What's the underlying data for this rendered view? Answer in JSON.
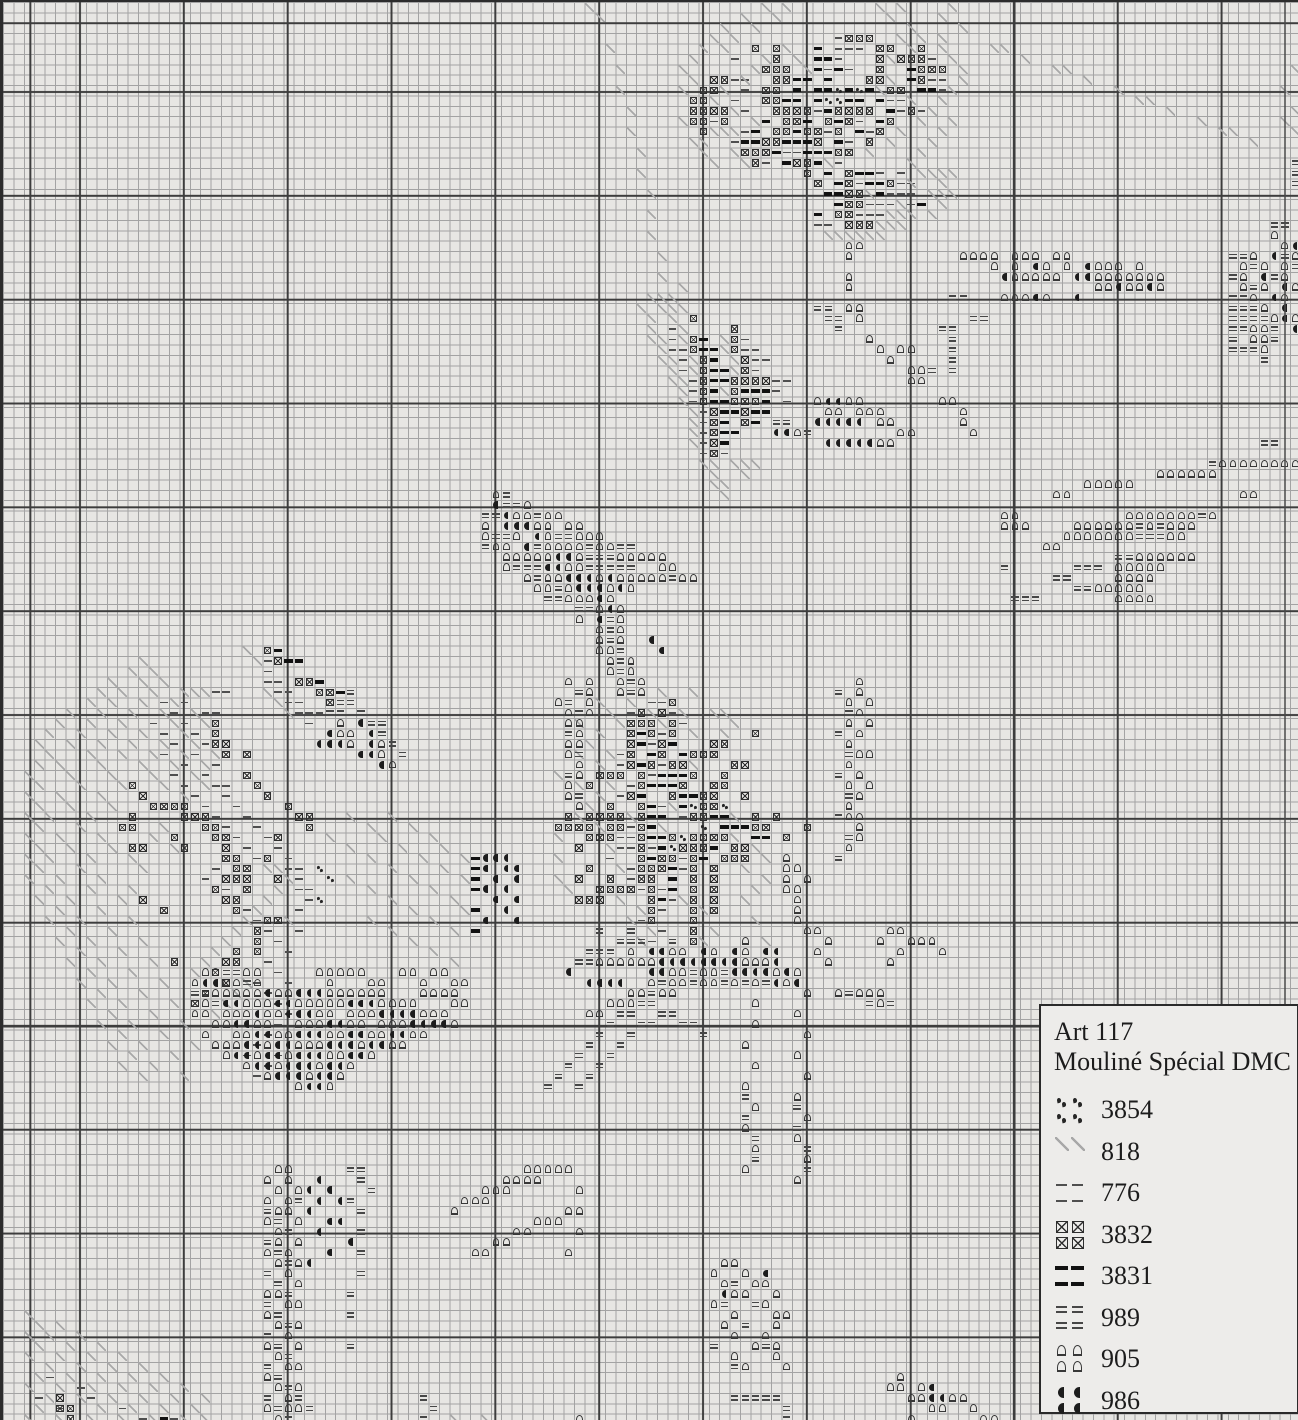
{
  "legend": {
    "title_line1": "Art 117",
    "title_line2": "Mouliné Spécial DMC",
    "entries": [
      {
        "code": "3854",
        "symbol": "3854",
        "icon": "double-dots-icon",
        "cells": 4
      },
      {
        "code": "818",
        "symbol": "818",
        "icon": "diagonal-line-icon",
        "cells": 2
      },
      {
        "code": "776",
        "symbol": "776",
        "icon": "thin-dash-icon",
        "cells": 4
      },
      {
        "code": "3832",
        "symbol": "3832",
        "icon": "boxed-x-icon",
        "cells": 4
      },
      {
        "code": "3831",
        "symbol": "3831",
        "icon": "bold-dash-icon",
        "cells": 4
      },
      {
        "code": "989",
        "symbol": "989",
        "icon": "double-dash-icon",
        "cells": 4
      },
      {
        "code": "905",
        "symbol": "905",
        "icon": "arch-icon",
        "cells": 4
      },
      {
        "code": "986",
        "symbol": "986",
        "icon": "half-moon-icon",
        "cells": 4
      }
    ]
  },
  "grid": {
    "cell": 10.38,
    "cols": 125,
    "rows": 137,
    "paper": "#e7e6e3",
    "thin_color": "#a3a3a3",
    "bold_color": "#3d3d3d",
    "bold_x_offset": 76,
    "bold_y_offset": 89
  },
  "symbol_colors": {
    "3854": "#262626",
    "818": "#a8a8a8",
    "776": "#4f4f4f",
    "3832": "#2e2e2e",
    "3831": "#121212",
    "989": "#474747",
    "905": "#383838",
    "986": "#1c1c1c"
  },
  "pattern": {
    "3854": [
      "8:80,82",
      "9:79-80",
      "77:66,69",
      "79:67",
      "80:65",
      "81:64",
      "83:30",
      "84:31",
      "86:30"
    ],
    "818": [
      "0:56,73,75,84,86,91",
      "1:57,71,74,85,90",
      "2:69,72,87,92",
      "3:68,70,86,88,90",
      "4:58,67,69,75,87,90,95-96",
      "5:66,73,76,85,91,98",
      "6:59,65,72,77,92,101-102,124",
      "7:66,71,85,92,104",
      "8:59,65,69,84,91,107,123",
      "9:68,87,90,109-110",
      "10:60,70,89,112,124",
      "11:65,72,88,91,115,123",
      "12:60,68-70,86,90,117-118,124",
      "13:66-67,85,89,120",
      "14:61,67,70,83,88",
      "15:68,71,79,87",
      "16:61,88-91",
      "17:87,90",
      "18:62,83,89-91",
      "19:86,90",
      "20:62,85-87,89",
      "21:84-86",
      "22:62,79-84",
      "24:63",
      "26:63",
      "27:65",
      "28:62-64",
      "29:61,63-65",
      "30:62,64",
      "31:62,65",
      "32:62-63,65,69",
      "33:63,69",
      "34:63-64,66,70",
      "35:64,66,70",
      "36:64-65",
      "37:65,69",
      "38:65",
      "39:66",
      "40:66",
      "41:66",
      "42:66",
      "44:67-68,70-72",
      "45:68,71",
      "46:68-69",
      "47:69",
      "62:23",
      "63:13,24",
      "64:12,14",
      "65:10,13,15",
      "66:9,11,14,17-19,25",
      "67:8,10,13,16,26",
      "68:6,9,12,15,18,27",
      "69:5,8,11,16,19",
      "70:4,7,10,13,17",
      "71:3,6,9,12,15,18",
      "72:4,8,11,14,17,20",
      "73:3,5,9,13,16,19",
      "74:2,6,10,14,18",
      "75:3,7,11,15,19",
      "76:2,5,9,17",
      "77:3,6,10",
      "78:2,4,8,33,37",
      "79:3,7,15,35,39",
      "80:2,5,9,14,31,36,41",
      "81:3,6,10,16,33,38,42",
      "82:2,4,8,12,35,40,44",
      "83:3,7,13,25-26,37,42",
      "84:2,5,9,27,33,39,44",
      "85:4,8,12,26,35,41",
      "86:3,6,11,25,37,43",
      "87:5,9,24,39,44",
      "88:4,7,12,23,27,35,41",
      "89:6,10,22,37,43",
      "90:5,8,13,21,39",
      "91:7,11,20,41",
      "92:6,9,14,19,43",
      "93:8,12,18",
      "94:7,10,15,23",
      "95:9,13,22",
      "96:8,11,16,21",
      "97:10,14,20",
      "98:9,12,17",
      "99:11,15",
      "100:10,13,18",
      "101:12,16",
      "102:11,14",
      "103:13,17",
      "66:63,66",
      "67:57,60",
      "68:58,62,65,68-69",
      "69:55,59,63,70",
      "70:57,66,69",
      "71:56",
      "72:55,58",
      "73:57,66",
      "74:53",
      "75:55,58",
      "76:57",
      "77:56,64",
      "78:55,60,70",
      "79:57,63",
      "80:53,70",
      "81:58,72",
      "82:53,73",
      "83:59,71",
      "84:53,73",
      "85:54,72",
      "86:59,65,71",
      "87:61,67",
      "88:60,72",
      "89:62,68",
      "90:61,67,73",
      "126:2",
      "127:3,5",
      "128:2,4,7",
      "129:3,6,9",
      "130:2,5,8,11",
      "131:4,7,10,13",
      "132:3,6,9,12,15",
      "133:2,5,8,11,14,17",
      "134:4,7,10,13,16,19",
      "135:3,9,12,15,18",
      "136:2,5,8,11,14,17,19,43,46"
    ],
    "776": [
      "3:80",
      "4:80-82",
      "5:70,80,89",
      "6:79,81",
      "7:70-71,89-90",
      "8:71,90",
      "9:70,85-86",
      "10:71,78,86,88",
      "11:68,82",
      "12:71,79,83",
      "13:70,81",
      "14:75-76",
      "15:73,80",
      "16:84,86",
      "17:82,86-87",
      "18:85-87",
      "19:83-85,87",
      "20:82-84",
      "21:78-79",
      "31:64",
      "32:64,71",
      "33:64-65,71-72",
      "34:65,72-73",
      "35:65,72",
      "36:66,74-75",
      "37:66,74",
      "38:66,75",
      "39:67",
      "40:67",
      "41:67",
      "42:67",
      "43:67,69",
      "63:25",
      "64:25",
      "65:25-26",
      "66:26-27",
      "67:27-28",
      "68:28-30",
      "69:29",
      "66:20-21",
      "67:15,17",
      "68:16,19-20",
      "69:14,17",
      "70:15,18",
      "71:16,19",
      "72:15,18",
      "73:17,20",
      "74:16,19",
      "75:17,20-21",
      "76:18,21",
      "77:19,22",
      "78:20,23",
      "79:21,24",
      "80:22,25",
      "81:23,26",
      "82:24,27",
      "83:20,27-28",
      "84:19,28",
      "85:21,28-29",
      "86:29",
      "87:23,28",
      "88:24",
      "89:25,28",
      "90:26",
      "91:27",
      "92:25",
      "93:26",
      "94:24,27",
      "95:25",
      "96:26",
      "97:27",
      "98:26",
      "99:25",
      "100:24",
      "101:23,26",
      "102:25",
      "103:24",
      "67:62-63",
      "68:60,64",
      "69:65",
      "70:63",
      "71:62",
      "72:59",
      "73:59,63",
      "74:62",
      "75:60",
      "76:59",
      "77:63",
      "78:65",
      "79:60",
      "80:59-60",
      "81:59-60,62",
      "82:58,65",
      "83:60,65",
      "84:60",
      "85:61,63",
      "86:64",
      "87:63",
      "88:61",
      "89:63",
      "90:62",
      "132:4",
      "133:7",
      "134:3,8",
      "135:5,11",
      "136:13,16"
    ],
    "3832": [
      "3:81-83",
      "4:72,74,84-85,88",
      "5:74,84,86-88",
      "6:73-75,84,88-90",
      "7:68-69,74-75,83-84,88",
      "8:67-68,73-74,85-86",
      "9:66-67,73-74",
      "10:66-69,74-77,80-83,87",
      "11:66-67,69,75-76,79,81,85",
      "12:67,74-75,77-78,80,84",
      "13:73-74,78,83",
      "14:71-73,80-81",
      "15:72,76-77",
      "16:77,81",
      "17:78,81,85",
      "18:81-82",
      "19:81-82",
      "20:80-81",
      "21:81-83",
      "30:66",
      "31:70",
      "32:66,70",
      "33:66,70",
      "34:67,71",
      "35:67,71",
      "36:67,70-73",
      "37:67,70",
      "38:67,70-72",
      "39:68,71",
      "40:68,71",
      "41:68",
      "42:68",
      "43:68",
      "62:25",
      "63:26",
      "65:28-29",
      "66:30-31",
      "67:31",
      "69:20",
      "70:20",
      "71:20-21",
      "72:21,23",
      "74:23",
      "75:12,24",
      "76:13,25",
      "77:14-17,27",
      "78:12,17-19,28-29",
      "79:11-12,19-20,29",
      "80:16,20-21,26",
      "81:12-13,17,21",
      "82:21-22,25",
      "83:22-23",
      "84:21-23,26",
      "85:20,23",
      "86:13,21-22",
      "87:15,22",
      "88:25-26",
      "89:24",
      "90:24",
      "91:22,24",
      "92:16,21-22",
      "93:20",
      "94:21",
      "95:19",
      "96:18",
      "67:64",
      "68:61,63",
      "69:60-62,64",
      "70:60,62,64,72",
      "71:60,63,68-69",
      "72:60,63,66-68",
      "73:60,62,64-65,70-71",
      "74:57-59,61,66,69",
      "75:56,61,65,68-69",
      "76:60,64,67-68,71",
      "77:58,61,67-68",
      "78:54,56-59,61,66-67,72,74",
      "79:53-56,58-59,61,72-73,77",
      "80:56-58,61,64,66-69,75",
      "81:55,61,65-67,70-71",
      "82:61,63-64,66,69-71",
      "83:56,61-63,66,68",
      "84:55,58,61-62,66,68",
      "85:57-60,62,66,68",
      "86:55-57,62,66,68",
      "87:62,66,68",
      "88:62,66",
      "89:66",
      "90:66",
      "134:5",
      "135:5-6",
      "136:6"
    ],
    "3831": [
      "4:78",
      "5:78-79",
      "6:78,80,87",
      "7:76-77,79,87",
      "8:76,78-79,81,83,88-89",
      "9:75-76,78,81-82,84",
      "10:79,85",
      "11:73,77,80,84",
      "12:72,76,82",
      "13:71-72,75-77,80",
      "14:74,77-79",
      "15:75,78",
      "16:79,82-83",
      "17:80,83-84",
      "18:79-80,84",
      "19:80,88",
      "20:78",
      "32:67",
      "33:67-68",
      "34:68",
      "35:68-69",
      "36:68-69",
      "37:68,71-73",
      "38:68-69,73",
      "39:69-70,72-73",
      "40:69,72",
      "41:69-70",
      "42:69",
      "62:26",
      "63:27-28",
      "65:30",
      "66:32",
      "82:45",
      "83:45",
      "84:45",
      "85:45",
      "87:45",
      "89:45",
      "70:61",
      "71:61,64",
      "72:62,65",
      "73:61",
      "74:63-65",
      "75:62-64",
      "76:61,65-66",
      "77:62,65",
      "78:62-63,68-69",
      "79:62,69-71",
      "80:62-63,72-73",
      "81:63,68",
      "82:62,67",
      "83:64",
      "84:64",
      "85:64",
      "86:63",
      "136:15"
    ],
    "989": [
      "15:124",
      "16:124",
      "17:124",
      "21:122-123",
      "24:118-119,123",
      "25:120,124",
      "26:118,122",
      "27:120",
      "28:91-92,118-119",
      "29:78-79,118-120",
      "30:79-80,93-94,118-121",
      "31:80,90-91,118-119,122",
      "32:91,118,122",
      "33:91,118-120",
      "34:91,121",
      "35:89,91",
      "42:121-122",
      "44:116",
      "49:115",
      "50:109,111",
      "51:109-111",
      "53:107-108",
      "54:96,103-105",
      "55:101-102",
      "56:103-104",
      "57:97-99",
      "47:48",
      "48:48-49",
      "49:46-47,51",
      "51:47-48,53-54",
      "52:46,51,56,59-60",
      "53:56-58",
      "54:49-51,56-60",
      "55:51,64",
      "56:53",
      "57:52-53",
      "58:55-56",
      "59:58",
      "60:58",
      "61:58",
      "62:59",
      "63:59",
      "64:59",
      "65:60",
      "66:60",
      "40:74-75",
      "41:77",
      "66:33",
      "67:32-33",
      "68:31-32,34",
      "69:35-36",
      "70:36",
      "71:37",
      "72:38",
      "66:55",
      "67:54",
      "68:55",
      "70:54",
      "72:55",
      "74:54",
      "76:55",
      "66:80",
      "68:81",
      "70:80",
      "72:81",
      "74:80",
      "76:81",
      "78:80",
      "80:81",
      "82:80",
      "89:57,60",
      "90:59-61,64",
      "91:56-58",
      "92:55-56",
      "93:21-22,66,69",
      "94:23,63,66,69,71,73",
      "95:18-19,62,81",
      "96:20,61-62,83,85",
      "97:59-60,63-64",
      "98:58,61-62,65-66",
      "99:57,60,67",
      "100:56,59",
      "101:55,58",
      "102:54,57",
      "103:53,56",
      "104:52,55",
      "105:71",
      "106:76",
      "107:71",
      "108:76",
      "109:72",
      "110:77",
      "111:72",
      "112:33-34,77",
      "113:34",
      "114:35",
      "115:28,33",
      "116:25,34",
      "117:26",
      "118:27,34",
      "119:25",
      "120:26,34",
      "121:27",
      "122:25,34",
      "123:26,70",
      "124:27,33",
      "125:25,69,72",
      "126:26,33",
      "127:27,71",
      "128:25",
      "129:26,33,68,73",
      "130:27",
      "131:25,70",
      "132:26",
      "133:27",
      "134:25,28,40,70-74",
      "135:26,29,41,75",
      "136:27,40,75"
    ],
    "905": [
      "22:122",
      "23:81-82,123",
      "24:81,92-95,97-99,101-102,120,124",
      "25:95,97,100,102,105-107,109,119,121,123",
      "26:81,97-101,105-111,119,123",
      "27:81,105-106,108-109,111,119,121,124",
      "28:96-98,100,120,123",
      "29:81-82,121",
      "30:82,122,124",
      "31:120-121",
      "32:83,120-121",
      "33:84,86-87,121",
      "34:85",
      "35:87-88",
      "36:87-88",
      "38:78,81-82,90-91",
      "39:79-80,82-84,92",
      "40:84-85,92",
      "41:76,86-87,93",
      "42:84-85",
      "44:117-124",
      "45:111-116",
      "46:104-108",
      "47:47,101-102,119-120",
      "48:50",
      "49:49-50,52-53,96-97,108-114,116",
      "50:46,51-52,54-55,96-98,103-108,110,112-114",
      "51:46,49,52,55-57,102-108,112-113",
      "52:47-48,52-55,57-58,100-101",
      "53:48-52,55,59-63,109-114",
      "54:48,54-55,63-64,107-111",
      "55:50,52-53,57,59-63,65-66,107-110",
      "56:51-52,54,58,60,105-109",
      "57:54-56,58,107-110",
      "58:57,59",
      "59:55,59",
      "60:57,59",
      "61:57,59",
      "62:57-58",
      "63:58,60",
      "64:58,60",
      "65:54,56,59,61,82",
      "66:56,59,61,82",
      "67:53,56,81,83",
      "68:54,56,82",
      "69:54-55,81,83",
      "70:55,82",
      "71:54-55,81",
      "72:54,82-83",
      "73:55,81",
      "74:55,82",
      "75:54,81,83",
      "76:54,82",
      "77:55,81",
      "78:81-82",
      "79:82",
      "80:82",
      "81:81",
      "69:32",
      "70:32-33",
      "71:33,36",
      "72:36",
      "73:37",
      "82:75",
      "83:75-76",
      "84:75,77",
      "85:75-76",
      "86:76",
      "87:76",
      "88:76",
      "89:77-78,85-86",
      "90:71,79,84,87-89",
      "91:60,64-65,68,71,78,86,90",
      "92:57-62,71-73,79,85",
      "93:19-20,23-24,30-34,38-39,41-42,64-65,67-68,74,76",
      "94:18,21-22,24,31,35-36,40,43-44,62,64-65,67-68,70,72,75",
      "95:20-24,26-27,31-36,40-43,60-61,63-64,77,80,82-84",
      "96:19,23-25,28-32,36-39,43-44,58-60,72,84",
      "97:18-19,21-23,25-26,30-31,33-35,40-42,56-57,76",
      "98:20-21,24-25,28-30,33-34,36-38,43,72",
      "99:19,22-23,26-27,31-32,35-36,39-40,77",
      "100:20-22,25,28-30,34,37-38,71",
      "101:21,24,27,31-32,35,76",
      "102:23,26,30,33,72",
      "103:25,29,32,77",
      "104:28,31,71",
      "105:76",
      "106:72",
      "107:77",
      "108:71",
      "109:76",
      "110:72",
      "111:77",
      "112:26-27,50-54,71",
      "113:25,27,48-51,76",
      "114:26,28,46-48,55",
      "115:25,27,44-46",
      "116:26-27,43,54-55",
      "117:25,28,51-53",
      "118:26,49-50,55",
      "119:26,28,47-48",
      "120:25,27,45-46,54",
      "121:26,28,69-70",
      "122:27,68,71",
      "123:28,69,72-73",
      "124:25-26,70-71,74",
      "125:27-28,68,73",
      "126:25,70,74-75",
      "127:26,28,69,74",
      "128:27,70,73",
      "129:25,28,72,74",
      "130:26,70,74",
      "131:27-28,71,75",
      "132:25,86",
      "133:26,28,85-86,88",
      "134:27,87-88,91-92",
      "135:25,27-28,89-90,93",
      "136:26,55,87,94-95"
    ],
    "986": [
      "23:124",
      "24:122",
      "25:99,104",
      "26:96,103-104,121",
      "27:107,110,123",
      "28:99,103,122",
      "29:123",
      "30:123",
      "31:124",
      "38:79-80",
      "40:78-82",
      "41:74-75",
      "42:79-83",
      "48:47",
      "49:48",
      "50:48-50",
      "51:51",
      "52:50",
      "53:53-54",
      "54:52-53",
      "55:54-56,58",
      "56:55-57,59",
      "57:57",
      "58:58",
      "59:57",
      "61:62",
      "62:63",
      "69:34",
      "70:31,35",
      "71:30-32,35",
      "72:34-35",
      "73:36",
      "82:46-48",
      "83:46,48-49",
      "84:47,49",
      "85:46,48",
      "86:47,49",
      "87:48",
      "88:46,49",
      "91:62-63,67,70,73-74",
      "92:63-70,74",
      "93:54,62-63,70-73,75",
      "94:19-20,56-59,74,76",
      "95:25,28-30",
      "96:21-22,26-27,33-35",
      "97:24,27-29,36-39",
      "98:22-23,31-32,39-42",
      "99:24-25,28-30,33-34,37-38",
      "100:23-24,26-27,31-33,35-36",
      "101:22-23,25-26,28-30,33-34",
      "102:24-25,27-29,31-32",
      "103:26-28,30-31",
      "104:29-30",
      "113:30",
      "114:29,31",
      "115:30,32",
      "116:29",
      "117:31-32",
      "118:30",
      "119:33",
      "120:31",
      "121:29",
      "122:73",
      "124:69",
      "133:89",
      "134:89-90"
    ]
  }
}
